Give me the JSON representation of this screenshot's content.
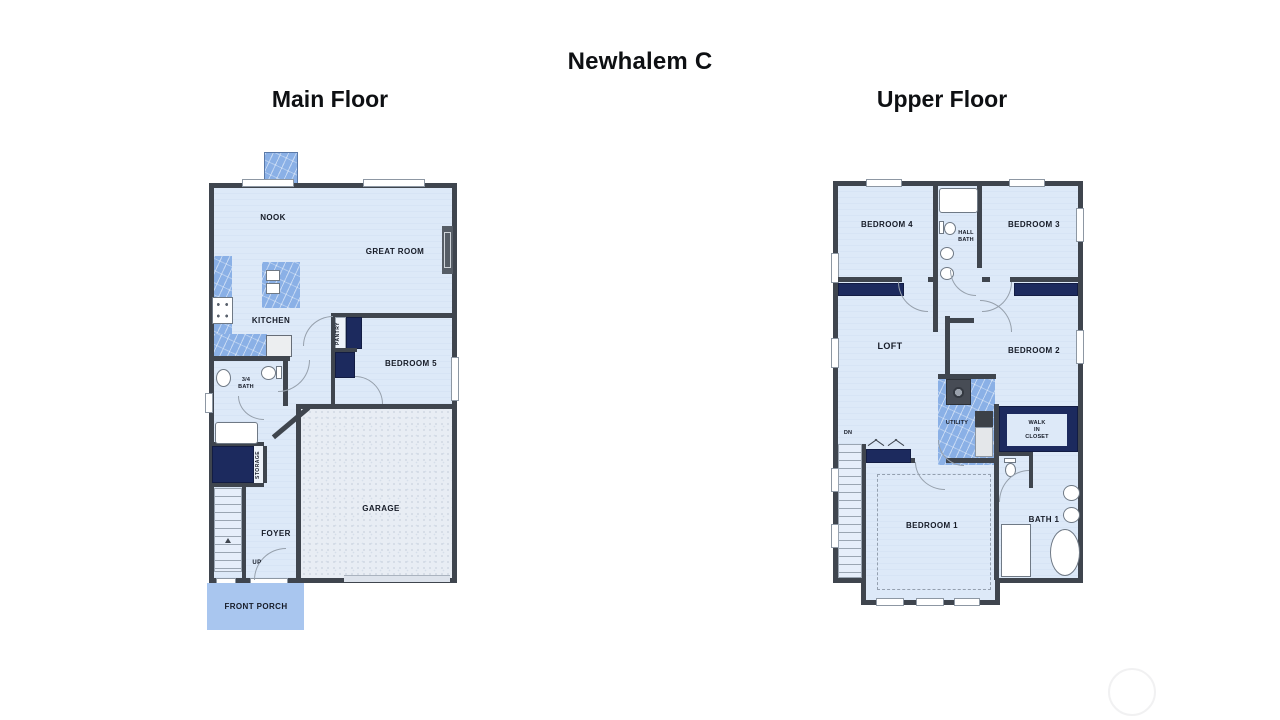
{
  "title": "Newhalem C",
  "plans": {
    "main": {
      "heading": "Main Floor",
      "labels": {
        "nook": "NOOK",
        "great_room": "GREAT ROOM",
        "kitchen": "KITCHEN",
        "pantry": "PANTRY",
        "bedroom5": "BEDROOM 5",
        "bath_34": "3/4\nBATH",
        "storage": "STORAGE",
        "foyer": "FOYER",
        "up": "UP",
        "garage": "GARAGE",
        "front_porch": "FRONT PORCH"
      }
    },
    "upper": {
      "heading": "Upper Floor",
      "labels": {
        "bedroom4": "BEDROOM 4",
        "hall_bath": "HALL\nBATH",
        "bedroom3": "BEDROOM 3",
        "loft": "LOFT",
        "bedroom2": "BEDROOM 2",
        "utility": "UTILITY",
        "walk_in_closet": "WALK\nIN\nCLOSET",
        "dn": "DN",
        "bedroom1": "BEDROOM 1",
        "bath1": "BATH 1"
      }
    }
  },
  "colors": {
    "wall": "#3f454e",
    "floor": "#dce8f7",
    "counter_blue": "#8ab0e6",
    "closet_navy": "#1c2a5e",
    "porch_blue": "#a9c6ef",
    "garage_floor": "#e8edf4",
    "label_text": "#161b27"
  }
}
